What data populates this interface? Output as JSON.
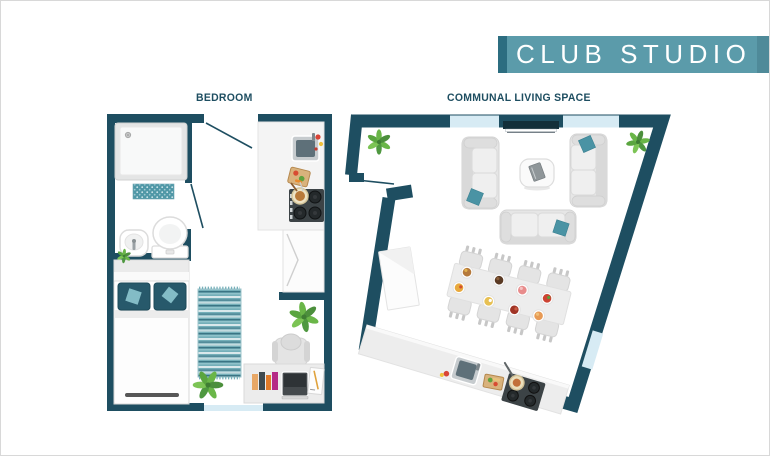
{
  "banner": {
    "title": "CLUB STUDIO"
  },
  "labels": {
    "bedroom": "BEDROOM",
    "communal": "COMMUNAL LIVING SPACE"
  },
  "colors": {
    "floor": "#ffffff",
    "wall": "#1e4e61",
    "window_glass": "#d7ebf4",
    "banner_bg": "#5b9baa",
    "banner_accent": "#2c6d80",
    "banner_fold": "#4f8a99",
    "accent_teal": "#4a93a4",
    "pillow_dark": "#27596b",
    "plant_green": "#67b244",
    "furniture_gray": "#e9e9e9",
    "label_text": "#1e4e61"
  },
  "icons": {
    "bedroom_items": [
      "entrance-door-swing",
      "shower-tray",
      "bath-mat",
      "pedestal-sink",
      "toilet",
      "bathroom-door-swing",
      "shelf-plant",
      "bed",
      "pillows",
      "throw-rug",
      "floor-plant",
      "kitchenette-counter",
      "kitchen-sink",
      "cutting-board",
      "hob-with-pot",
      "wardrobe",
      "desk-chair",
      "desk",
      "books",
      "laptop",
      "notepad",
      "desk-plant",
      "window"
    ],
    "communal_items": [
      "entry-door-swing",
      "wall-tv",
      "windows",
      "corner-plant-left",
      "corner-plant-right",
      "sofa-left",
      "sofa-right",
      "sofa-bottom",
      "throw-pillows",
      "coffee-table",
      "dining-table",
      "dining-chairs",
      "dinner-plates",
      "sideboard-cabinet",
      "kitchen-counter",
      "kitchen-sink",
      "cutting-board",
      "hob-with-pan"
    ],
    "dining_chairs_count": 8,
    "dinner_plates_count": 8
  }
}
